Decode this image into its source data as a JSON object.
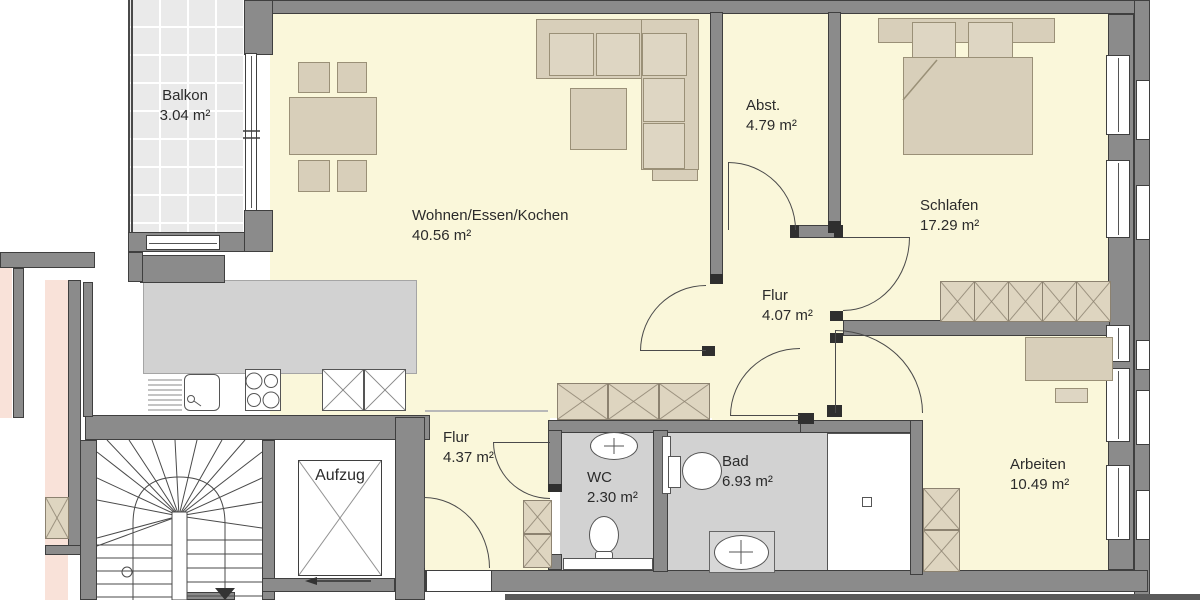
{
  "rooms": {
    "balkon": {
      "name": "Balkon",
      "area": "3.04 m²"
    },
    "wohnen": {
      "name": "Wohnen/Essen/Kochen",
      "area": "40.56 m²"
    },
    "abstellraum": {
      "name": "Abst.",
      "area": "4.79 m²"
    },
    "schlafen": {
      "name": "Schlafen",
      "area": "17.29 m²"
    },
    "flur_innen": {
      "name": "Flur",
      "area": "4.07 m²"
    },
    "flur_eingang": {
      "name": "Flur",
      "area": "4.37 m²"
    },
    "wc": {
      "name": "WC",
      "area": "2.30 m²"
    },
    "bad": {
      "name": "Bad",
      "area": "6.93 m²"
    },
    "arbeiten": {
      "name": "Arbeiten",
      "area": "10.49 m²"
    },
    "aufzug": {
      "name": "Aufzug"
    }
  },
  "colors": {
    "apartment_floor": "#faf7da",
    "wet_room_floor": "#d2d2d2",
    "wall": "#8b8b8b",
    "furniture": "#d8cfba",
    "wardrobe": "#ded5c0",
    "adjacent_unit": "#f9e2d9",
    "balcony_tile": "#eaeaea"
  }
}
